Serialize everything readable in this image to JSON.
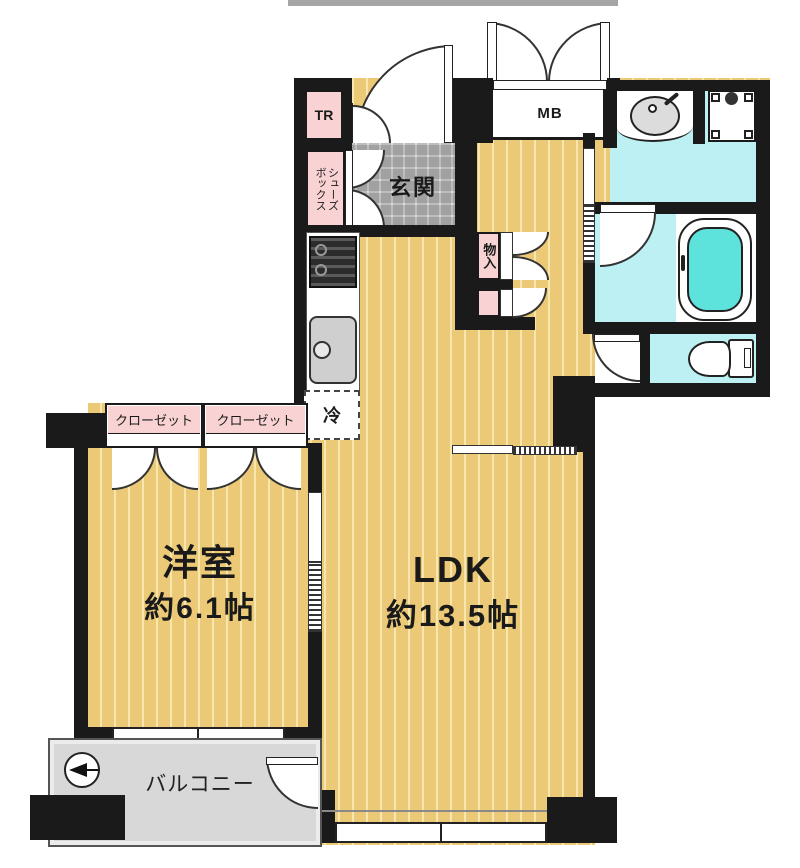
{
  "plan": {
    "rooms": {
      "western": {
        "name": "洋室",
        "size": "約6.1帖"
      },
      "ldk": {
        "name": "LDK",
        "size": "約13.5帖"
      },
      "entrance": {
        "label": "玄関"
      },
      "balcony": {
        "label": "バルコニー"
      }
    },
    "labels": {
      "tr": "TR",
      "mb": "MB",
      "shoes_line1": "シューズ",
      "shoes_line2": "ボックス",
      "storage": "物入",
      "fridge": "冷",
      "closet1": "クローゼット",
      "closet2": "クローゼット"
    },
    "colors": {
      "wall": "#1a1a1a",
      "wood_floor": "#ecc976",
      "wood_stripe": "#f7e6ae",
      "entrance_tile": "#dedede",
      "wet_area": "#bdf0f3",
      "bathtub": "#5ee2dc",
      "label_pink": "#f9d3d3",
      "balcony_gray": "#d8d8d8"
    }
  }
}
